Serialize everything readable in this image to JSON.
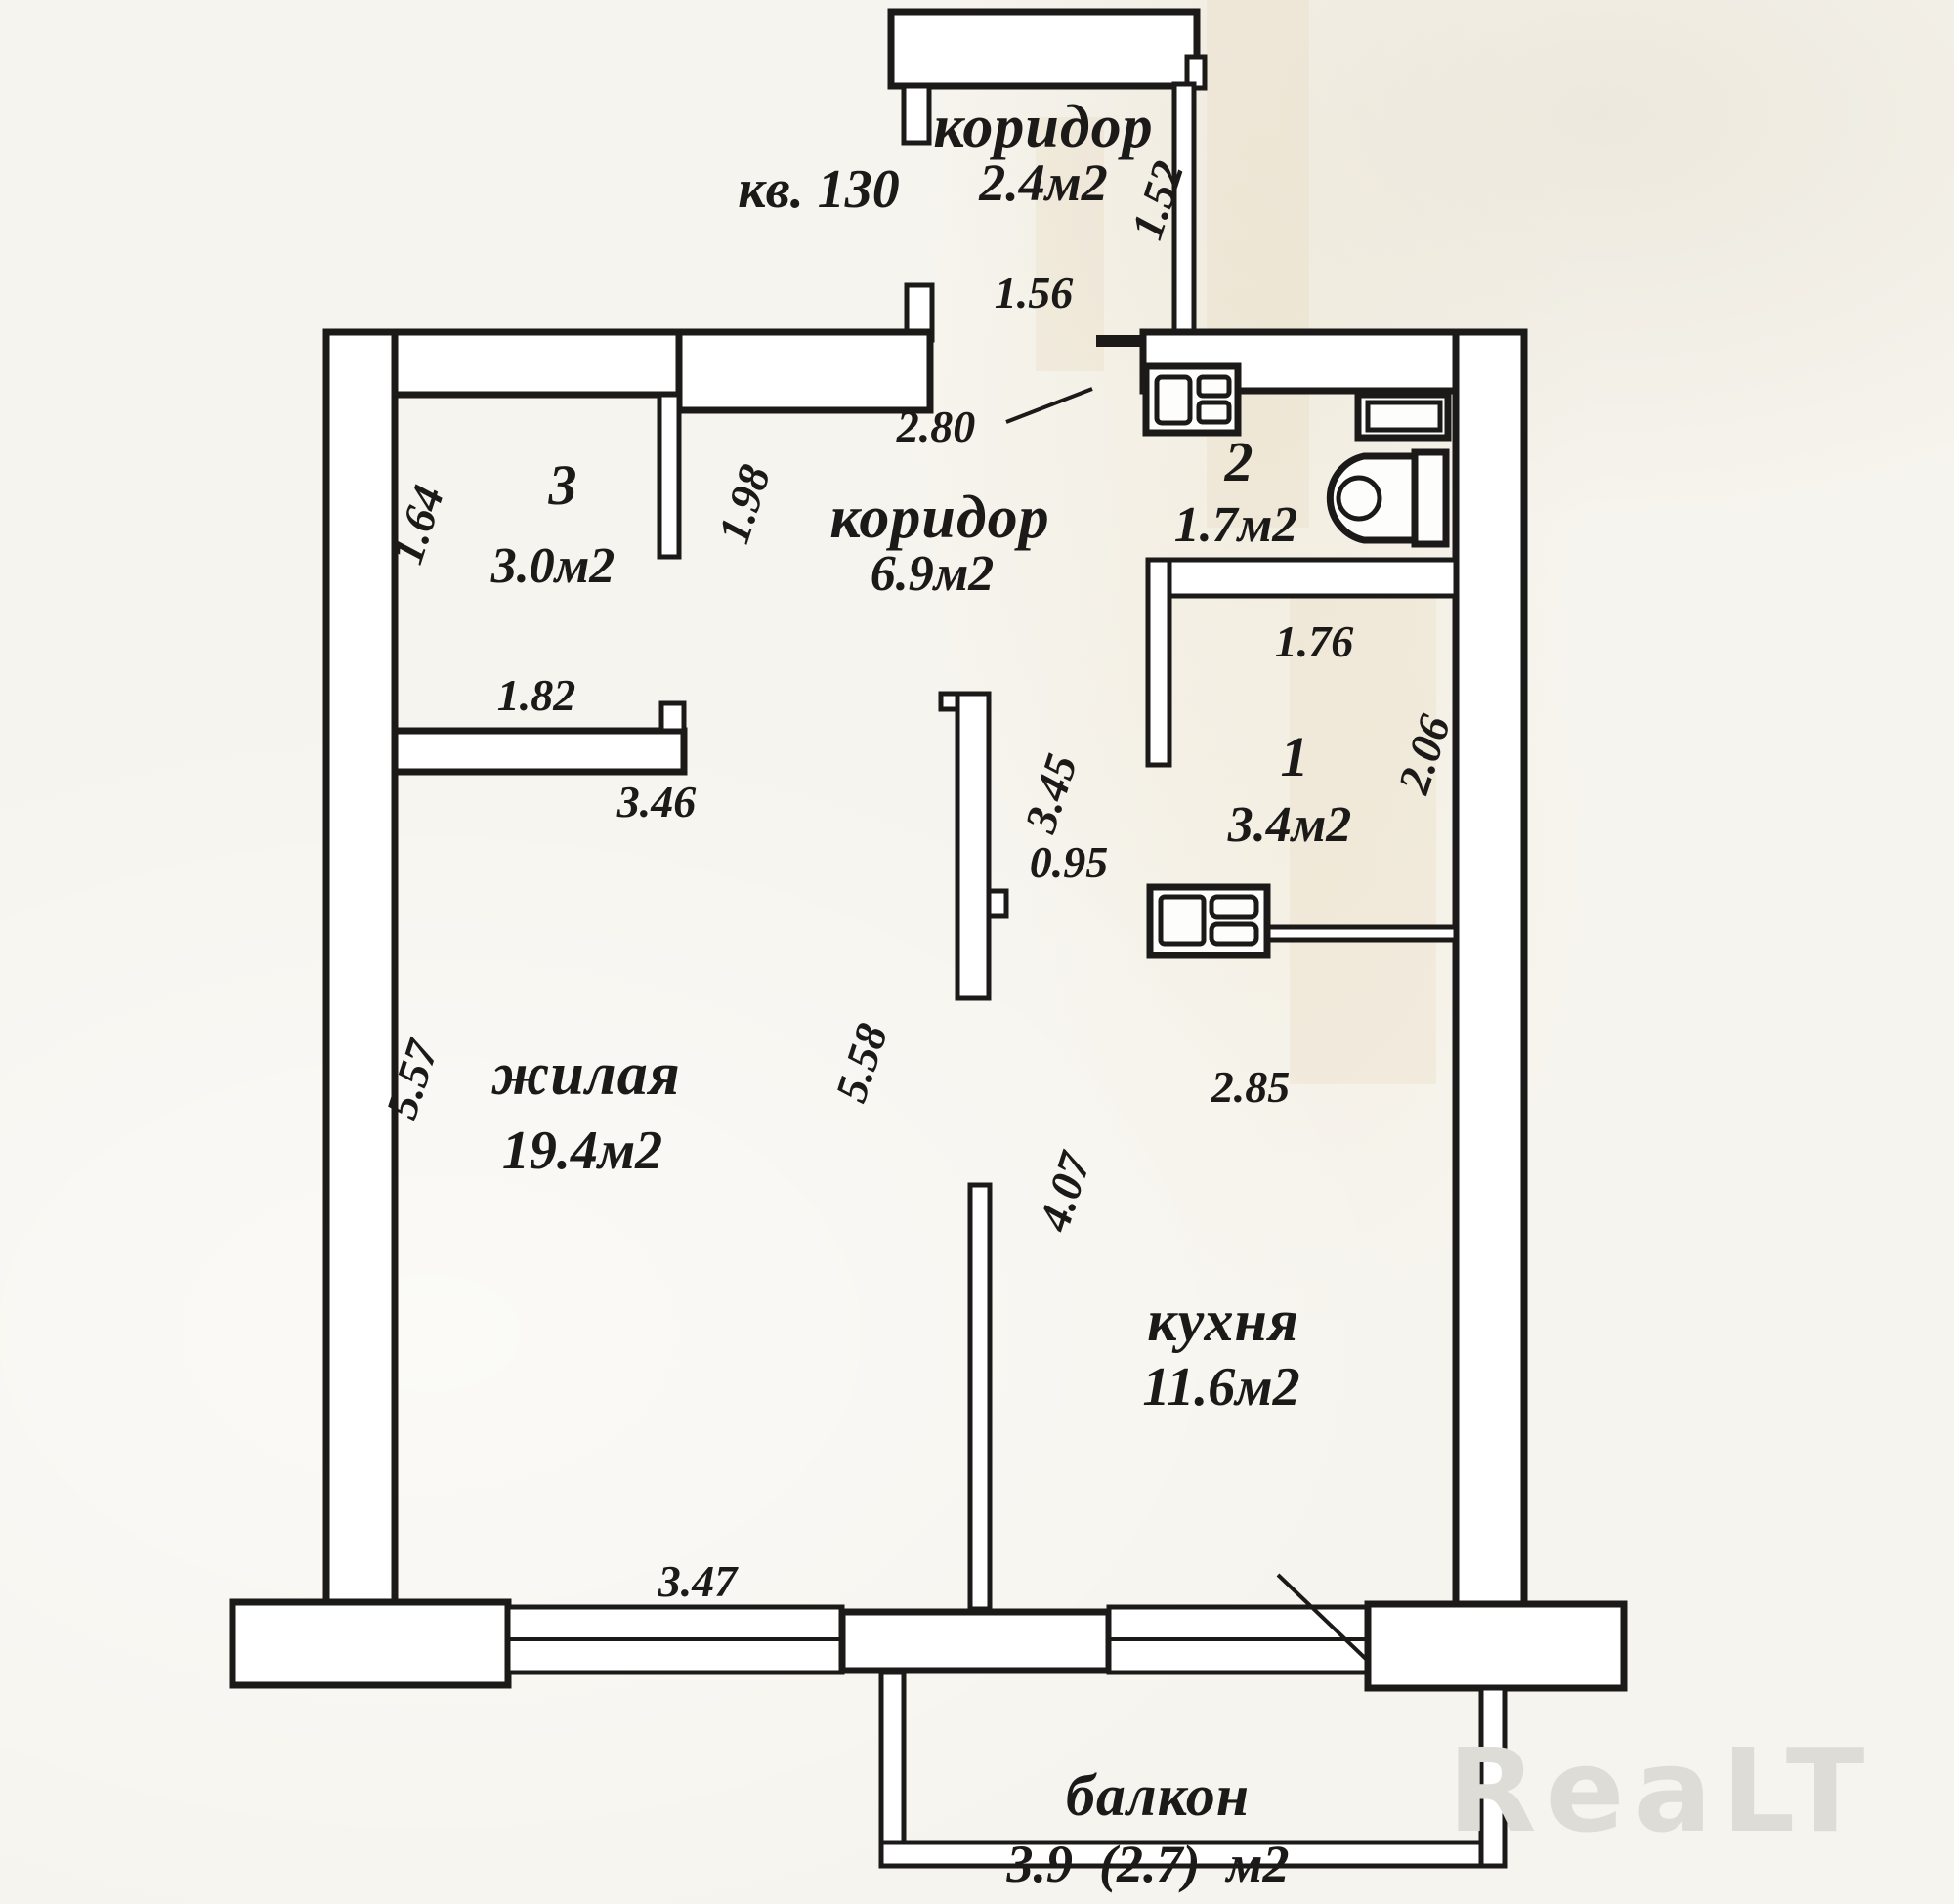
{
  "meta": {
    "title": "Apartment floor plan scan",
    "apartment_label": "кв. 130",
    "watermark": "ReaLT"
  },
  "colors": {
    "paper": "#f6f4ee",
    "ink": "#1b1a18",
    "watermark": "#dedcd6",
    "wall_fill": "#ffffff"
  },
  "icons": {
    "toilet": "toilet-icon",
    "bathroom_appliance": "sink-unit-icon",
    "room1_appliance": "stove-unit-icon"
  },
  "rooms": {
    "entry_corridor": {
      "name": "коридор",
      "area": "2.4м2"
    },
    "corridor": {
      "name": "коридор",
      "area": "6.9м2"
    },
    "room3": {
      "number": "3",
      "area": "3.0м2"
    },
    "room2": {
      "number": "2",
      "area": "1.7м2"
    },
    "room1": {
      "number": "1",
      "area": "3.4м2"
    },
    "living": {
      "name": "жилая",
      "area": "19.4м2"
    },
    "kitchen": {
      "name": "кухня",
      "area": "11.6м2"
    },
    "balcony": {
      "name": "балкон",
      "area": "3.9  (2.7)  м2"
    }
  },
  "dimensions": {
    "entry_depth": "1.52",
    "entry_width": "1.56",
    "corridor_top_width": "2.80",
    "room3_left_height": "1.64",
    "room3_partition": "1.98",
    "room3_bottom_width": "1.82",
    "corridor_length": "3.46",
    "room1_top_width": "1.76",
    "room1_right_height": "2.06",
    "partition_length": "3.45",
    "opening_width": "0.95",
    "living_left_height": "5.57",
    "living_right_height": "5.58",
    "kitchen_top_width": "2.85",
    "kitchen_left_height": "4.07",
    "living_bottom_width": "3.47"
  }
}
